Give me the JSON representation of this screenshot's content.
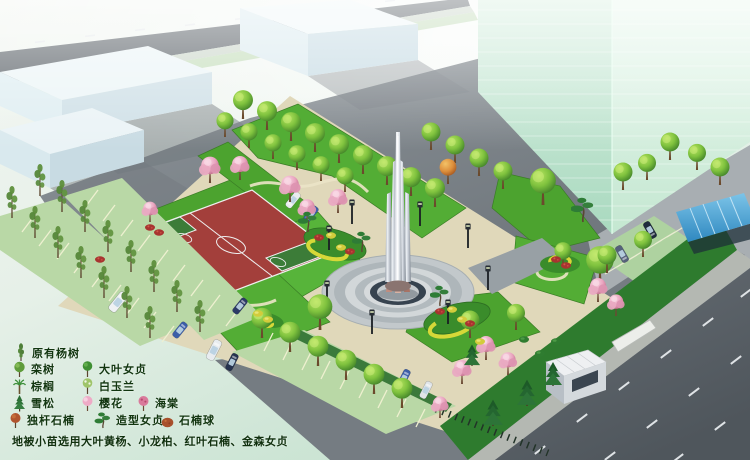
{
  "scene": {
    "kind": "landscape-plan-rendering",
    "features": [
      "central-monument-plaza",
      "basketball-court",
      "parking-rows",
      "office-tower",
      "gatehouse",
      "bike-shelter",
      "main-road"
    ]
  },
  "legend": {
    "items": [
      {
        "icon": "poplar-tree-icon",
        "label": "原有杨树"
      },
      {
        "icon": "koelreuteria-tree-icon",
        "label": "栾树"
      },
      {
        "icon": "bigleaf-privet-tree-icon",
        "label": "大叶女贞"
      },
      {
        "icon": "palm-tree-icon",
        "label": "棕榈"
      },
      {
        "icon": "white-magnolia-tree-icon",
        "label": "白玉兰"
      },
      {
        "icon": "cedar-tree-icon",
        "label": "雪松"
      },
      {
        "icon": "cherry-blossom-tree-icon",
        "label": "樱花"
      },
      {
        "icon": "crabapple-tree-icon",
        "label": "海棠"
      },
      {
        "icon": "single-stem-photinia-icon",
        "label": "独杆石楠"
      },
      {
        "icon": "shaped-privet-icon",
        "label": "造型女贞"
      },
      {
        "icon": "photinia-ball-icon",
        "label": "石楠球"
      }
    ],
    "note": "地被小苗选用大叶黄杨、小龙柏、红叶石楠、金森女贞"
  },
  "colors": {
    "court_red": "#a33f3b",
    "court_key_green": "#3c7c38",
    "lawn_green": "#4ca32f",
    "path_tan": "#e0d8ba",
    "tower_mint": "#cdeeda",
    "road_gray": "#575e64",
    "parking_green": "#b9d8a6",
    "shelter_blue": "#4fa8d8",
    "monument_ring_navy": "#37434f",
    "legend_text": "#11350f"
  }
}
